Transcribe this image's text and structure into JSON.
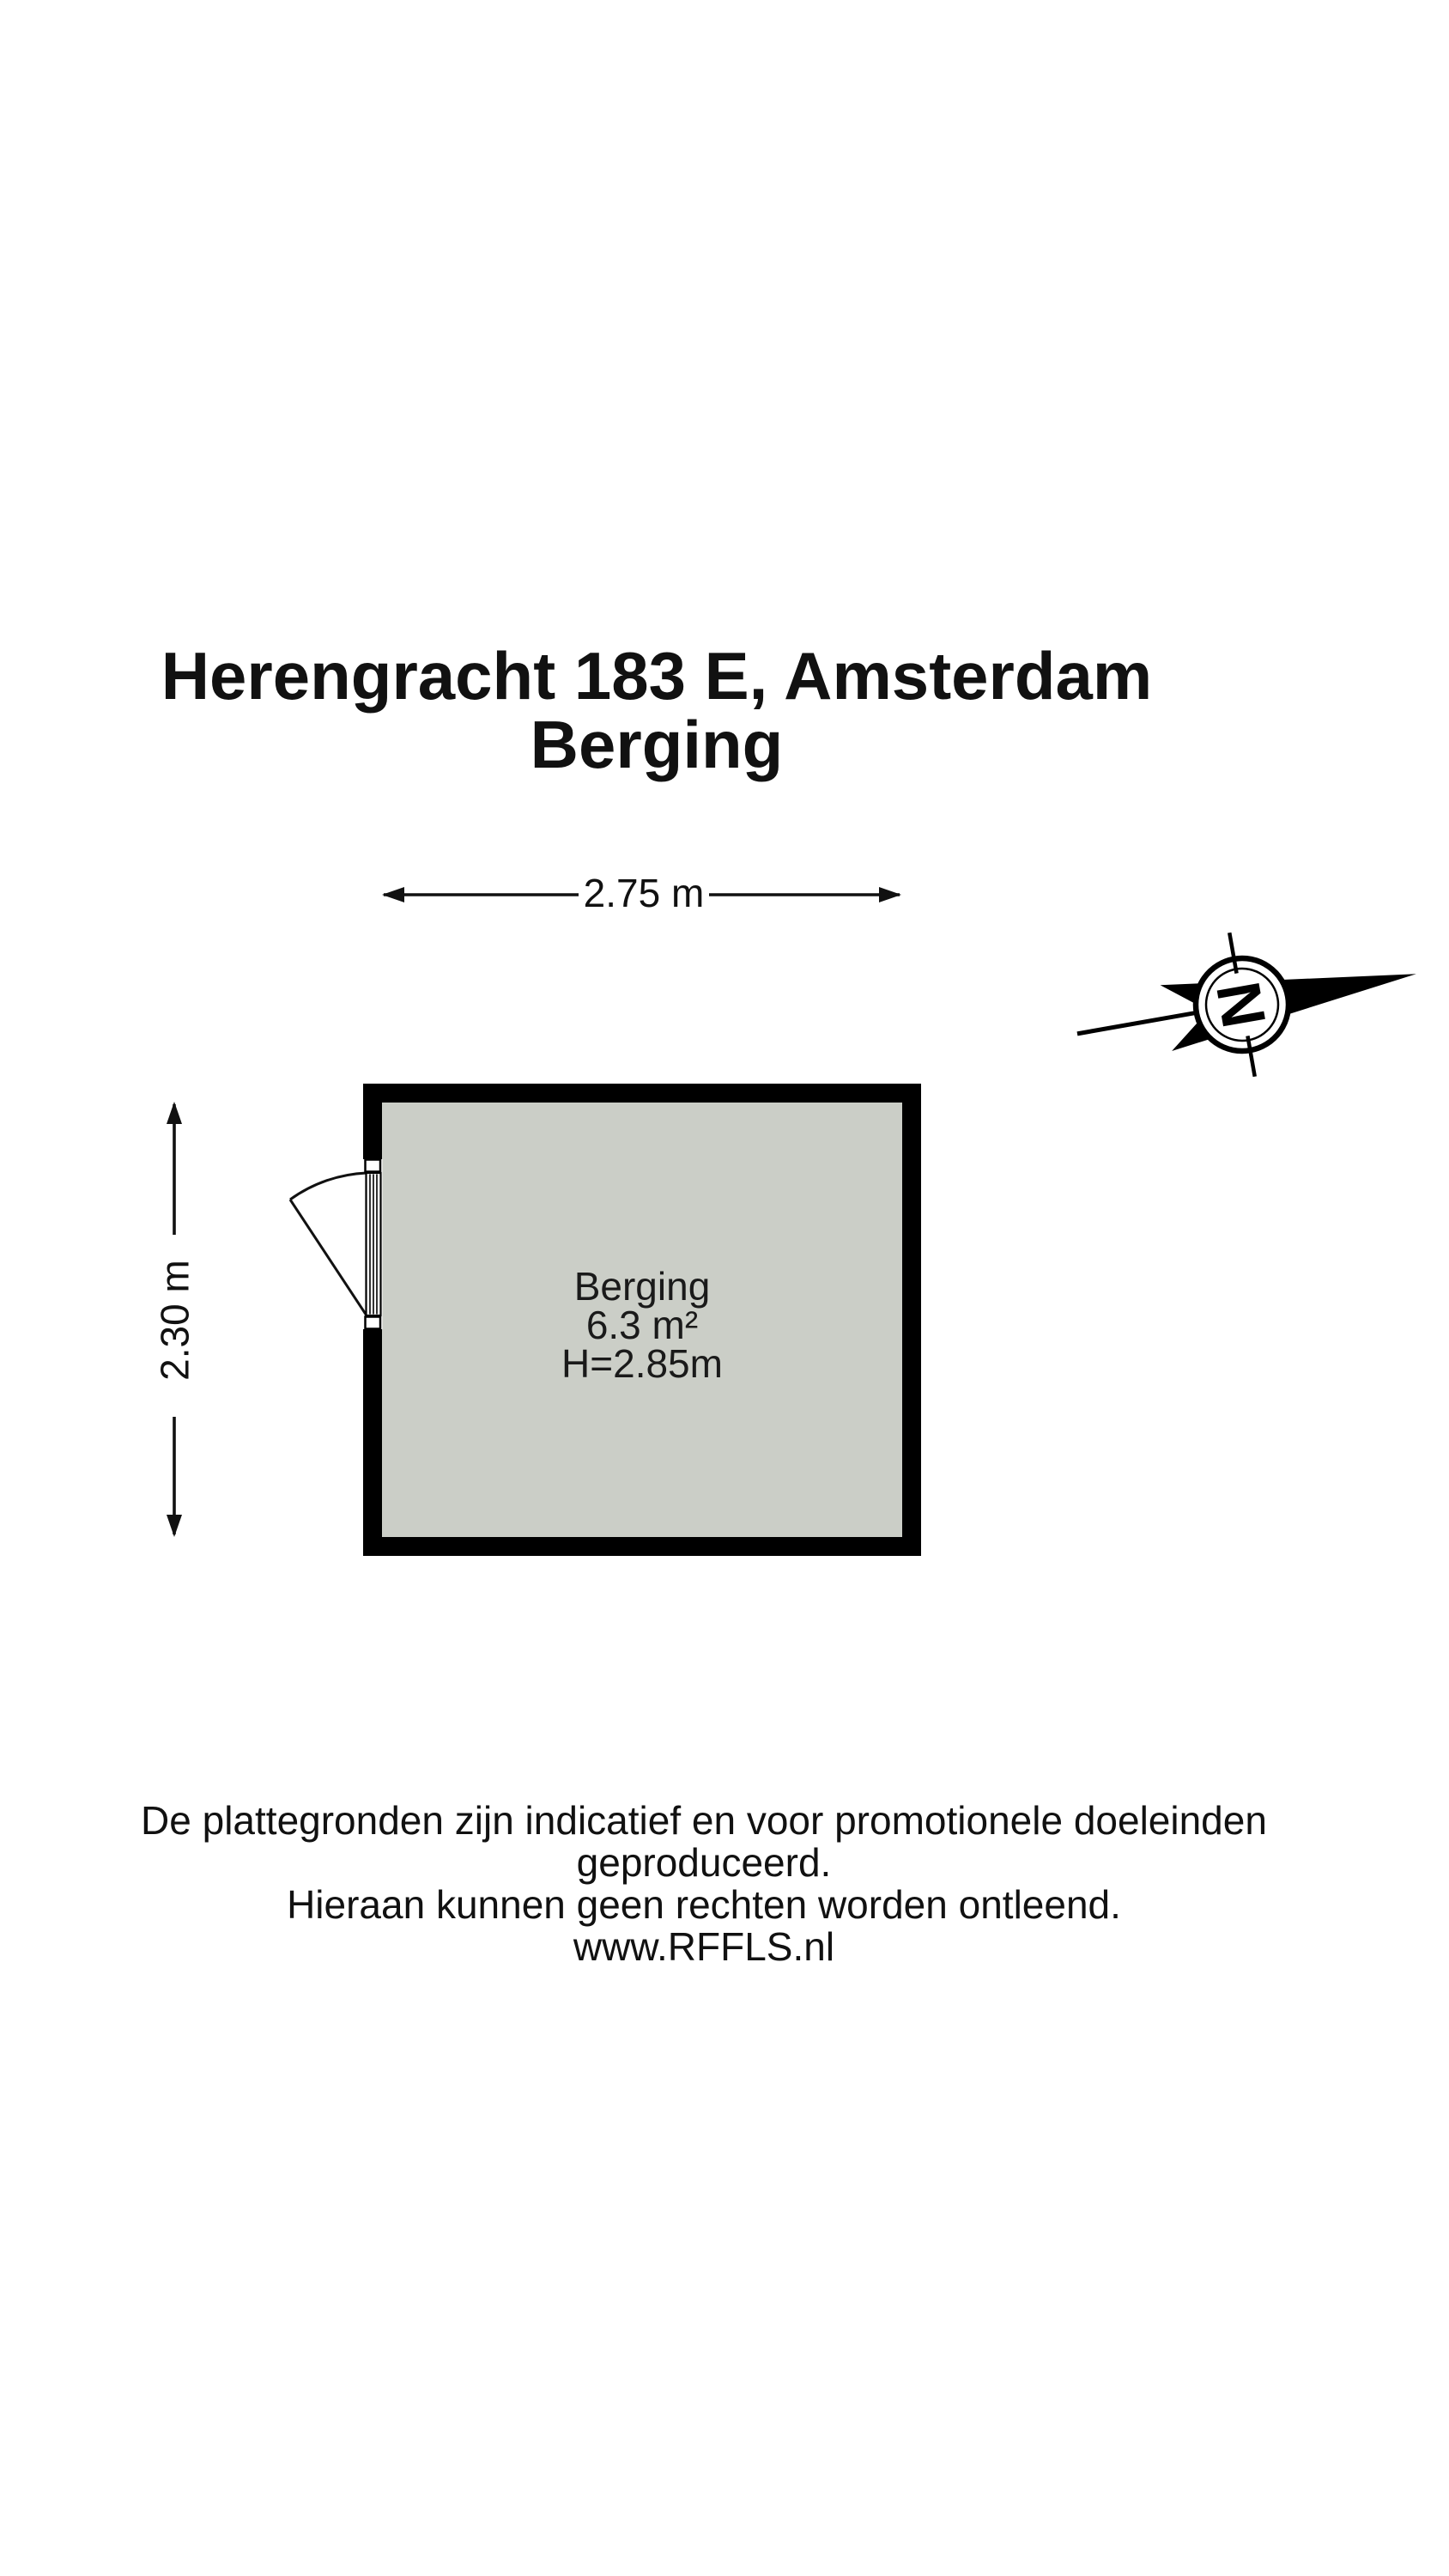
{
  "title": {
    "line1": "Herengracht 183 E, Amsterdam",
    "line2": "Berging"
  },
  "dimensions": {
    "width_label": "2.75 m",
    "height_label": "2.30 m"
  },
  "room": {
    "name": "Berging",
    "area": "6.3 m²",
    "ceiling_height": "H=2.85m"
  },
  "compass": {
    "letter": "N"
  },
  "footer": {
    "line1": "De plattegronden zijn indicatief en voor promotionele doeleinden geproduceerd.",
    "line2": "Hieraan kunnen geen rechten worden ontleend.",
    "line3": "www.RFFLS.nl"
  },
  "colors": {
    "wall": "#000000",
    "floor_fill": "#cbcec7",
    "background": "#ffffff",
    "line": "#111111"
  },
  "icons": {
    "north_arrow": "compass-north-arrow-icon"
  }
}
